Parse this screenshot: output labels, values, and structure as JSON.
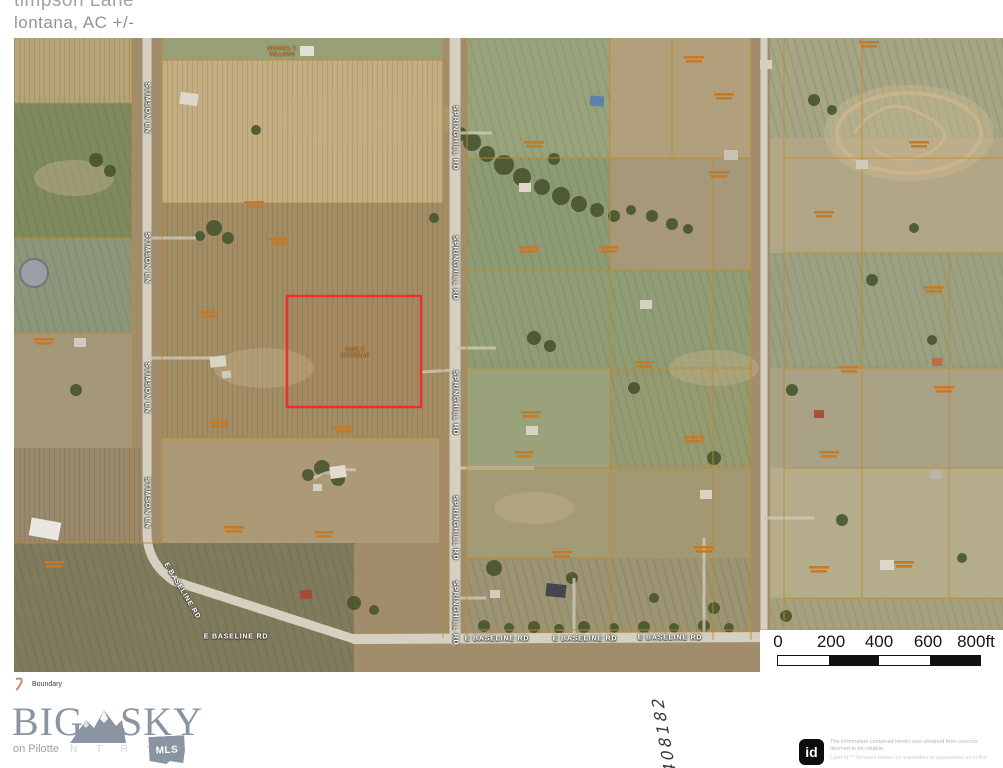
{
  "header": {
    "line1_clipped": "timpson Lane",
    "line2": "lontana,  AC +/-"
  },
  "map": {
    "road_labels": {
      "stimson": "STIMSON LN",
      "springhill": "SPRINGHILL RD",
      "baseline": "E BASELINE RD"
    },
    "subject_parcel": {
      "owner_line1": "CARL E",
      "owner_line2": "BRIDEMAN",
      "boundary_color": "#ee2f2b"
    },
    "owner_label": {
      "line1": "MICHAEL C",
      "line2": "WILLOWS"
    },
    "parcel_line_color": "#c08a2e",
    "road_color": "#d6d0c0"
  },
  "legend": {
    "boundary": "Boundary"
  },
  "scalebar": {
    "ticks": [
      "0",
      "200",
      "400",
      "600",
      "800ft"
    ]
  },
  "logo": {
    "big": "BIG",
    "sky": "SKY",
    "agent": "on Pilotte",
    "country_letters": "N T R Y",
    "mls": "MLS"
  },
  "annotation": {
    "handwritten_number": "408182"
  },
  "disclaimer": {
    "id_badge": "id",
    "line1": "The information contained herein was obtained from sources",
    "line2": "deemed to be reliable.",
    "line3": "Land id™ Services makes no warranties or guarantees as to the"
  }
}
